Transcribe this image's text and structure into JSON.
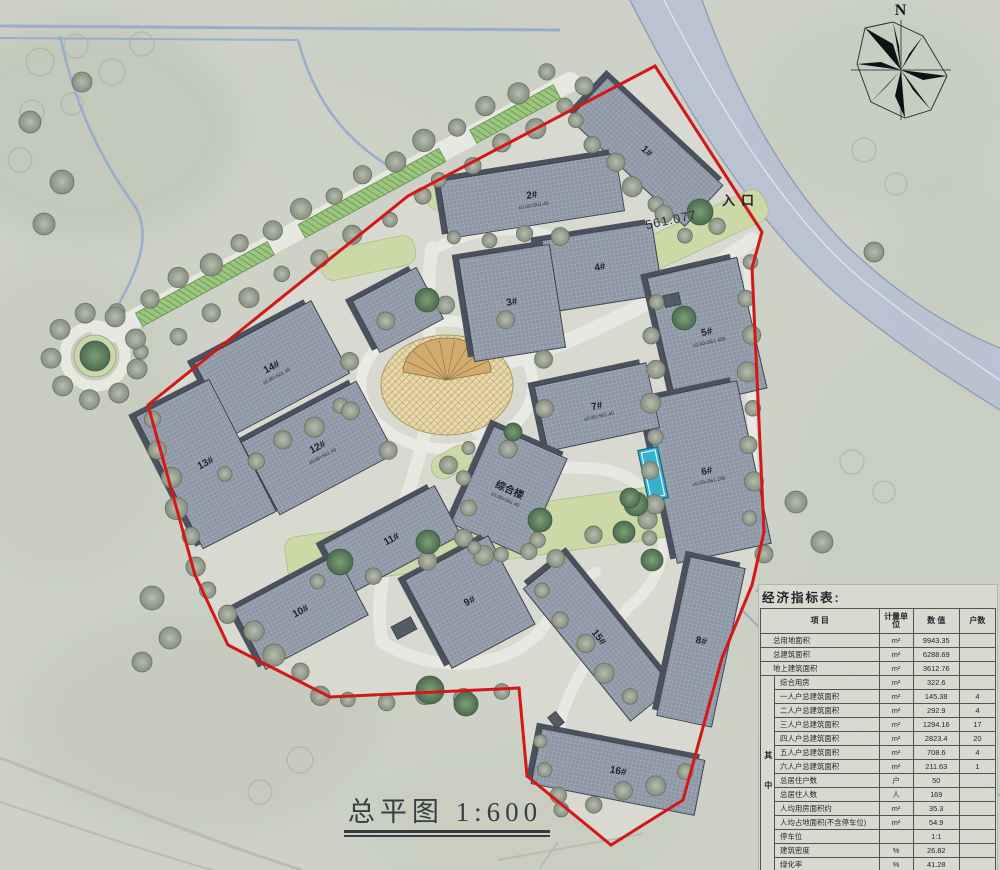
{
  "labels": {
    "north": "N",
    "entrance": "入口",
    "elevation": "561.077",
    "title": "总平图 1:600"
  },
  "table": {
    "title": "经济指标表:",
    "col_headers": [
      "项  目",
      "计量单位",
      "数  值",
      "户数"
    ],
    "among_label": "其中",
    "rows": [
      {
        "item": "总用地面积",
        "unit": "m²",
        "value": "9943.35",
        "count": "",
        "sub": false
      },
      {
        "item": "总建筑面积",
        "unit": "m²",
        "value": "6288.69",
        "count": "",
        "sub": false
      },
      {
        "item": "地上建筑面积",
        "unit": "m²",
        "value": "3612.76",
        "count": "",
        "sub": false
      },
      {
        "item": "综合用房",
        "unit": "m²",
        "value": "322.6",
        "count": "",
        "sub": true
      },
      {
        "item": "一人户总建筑面积",
        "unit": "m²",
        "value": "145.38",
        "count": "4",
        "sub": true
      },
      {
        "item": "二人户总建筑面积",
        "unit": "m²",
        "value": "292.9",
        "count": "4",
        "sub": true
      },
      {
        "item": "三人户总建筑面积",
        "unit": "m²",
        "value": "1294.16",
        "count": "17",
        "sub": true
      },
      {
        "item": "四人户总建筑面积",
        "unit": "m²",
        "value": "2823.4",
        "count": "20",
        "sub": true
      },
      {
        "item": "五人户总建筑面积",
        "unit": "m²",
        "value": "708.6",
        "count": "4",
        "sub": true
      },
      {
        "item": "六人户总建筑面积",
        "unit": "m²",
        "value": "211.63",
        "count": "1",
        "sub": true
      },
      {
        "item": "总居住户数",
        "unit": "户",
        "value": "50",
        "count": "",
        "sub": true
      },
      {
        "item": "总居住人数",
        "unit": "人",
        "value": "169",
        "count": "",
        "sub": true
      },
      {
        "item": "人均用房面积约",
        "unit": "m²",
        "value": "35.3",
        "count": "",
        "sub": true
      },
      {
        "item": "人均占地面积(不含停车位)",
        "unit": "m²",
        "value": "54.9",
        "count": "",
        "sub": true
      },
      {
        "item": "停车位",
        "unit": "",
        "value": "1:1",
        "count": "",
        "sub": true
      },
      {
        "item": "建筑密度",
        "unit": "%",
        "value": "26.82",
        "count": "",
        "sub": true
      },
      {
        "item": "绿化率",
        "unit": "%",
        "value": "41.28",
        "count": "",
        "sub": true
      },
      {
        "item": "容积率",
        "unit": "",
        "value": "0.65",
        "count": "",
        "sub": true
      }
    ]
  },
  "colors": {
    "ground": "#cdd1c7",
    "site": "#d8dad2",
    "road": "#e7e8e2",
    "road_band": "#b7c1d2",
    "boundary_red": "#d41717",
    "roof": "#8e97a6",
    "roof_shadow": "#4b525d",
    "tree_gray": "#9aa294",
    "tree_green": "#5d7f60",
    "lawn": "#ccd8a6",
    "hedge": "#9cc67e",
    "plaza": "#e8d9ab",
    "pool": "#38b0cc"
  },
  "map": {
    "boundary": "655,66 762,232 752,268 764,532 752,585 722,658 683,800 611,845 527,776 519,688 330,697 228,645 195,575 148,405 408,196",
    "band": {
      "fill": "M630,0 C690,120 762,232 848,304 C908,352 955,382 1000,410 L1000,348 C950,328 905,298 862,260 C800,206 742,112 702,0 Z",
      "edge1": "M630,0 C690,120 762,232 848,304 C908,352 955,382 1000,410",
      "edge2": "M702,0 C742,112 800,206 862,260 C905,298 950,328 1000,348",
      "center": "M664,0 C724,118 795,228 872,288 C925,330 962,354 1000,380"
    },
    "streams": [
      {
        "d": "M0,26 L560,30",
        "w": 3
      },
      {
        "d": "M0,38 L298,40",
        "w": 2
      },
      {
        "d": "M298,40 C312,92 338,136 392,168",
        "w": 2.5
      },
      {
        "d": "M60,36 C74,100 96,152 132,202 C150,226 144,258 122,298",
        "w": 2.5
      },
      {
        "d": "M122,298 C112,318 104,336 100,352",
        "w": 2
      }
    ],
    "faint_paths": [
      {
        "d": "M0,758 C90,792 200,838 302,870",
        "w": 3,
        "c": "#b9bdb0"
      },
      {
        "d": "M0,802 C70,826 150,852 212,870",
        "w": 2,
        "c": "#b9bdb0"
      },
      {
        "d": "M498,860 L642,834",
        "w": 2,
        "c": "#b9bdb0"
      },
      {
        "d": "M540,868 L558,842",
        "w": 2,
        "c": "#b9bdb0"
      },
      {
        "d": "M756,590 L1000,796",
        "w": 2,
        "c": "#9fabbd"
      },
      {
        "d": "M740,608 L978,850",
        "w": 2,
        "c": "#9fabbd"
      }
    ],
    "roads": [
      {
        "d": "M100,338 L570,82",
        "w": 20
      },
      {
        "d": "M752,240 C688,286 640,306 588,332 C544,352 506,362 476,372",
        "w": 15
      },
      {
        "d": "M432,248 C424,300 432,344 430,386 C428,436 414,476 398,522 C386,556 374,600 382,642",
        "w": 13
      },
      {
        "d": "M470,424 C506,458 544,468 584,468 C636,468 658,498 664,540",
        "w": 12
      },
      {
        "d": "M382,642 C440,678 520,668 548,620",
        "w": 12
      },
      {
        "d": "M430,252 C462,232 500,226 534,232 C570,240 602,252 622,262",
        "w": 11
      },
      {
        "d": "M664,540 C662,572 648,592 628,608",
        "w": 11
      },
      {
        "d": "M628,608 C600,640 572,680 562,716 C557,738 562,756 572,772",
        "w": 11
      },
      {
        "d": "M548,620 C560,600 576,584 596,572",
        "w": 10
      },
      {
        "d": "M748,258 C750,330 752,424 754,520",
        "w": 9
      }
    ],
    "roundabout": {
      "cx": 95,
      "cy": 356,
      "r_outer": 30,
      "r_inner": 21
    },
    "plaza": {
      "cx": 447,
      "cy": 385,
      "rx": 66,
      "ry": 50,
      "ring_rx": 86,
      "ring_ry": 64
    },
    "pool": {
      "cx": 653,
      "cy": 474,
      "w": 20,
      "h": 52,
      "rot": -12
    },
    "hedges": [
      {
        "cx": 205,
        "cy": 284,
        "w": 150,
        "h": 15,
        "rot": -28.5
      },
      {
        "cx": 372,
        "cy": 193,
        "w": 160,
        "h": 15,
        "rot": -28.5
      },
      {
        "cx": 515,
        "cy": 114,
        "w": 95,
        "h": 15,
        "rot": -28.5
      }
    ],
    "lawns": [
      {
        "cx": 480,
        "cy": 537,
        "w": 390,
        "h": 52,
        "rot": -8
      },
      {
        "cx": 688,
        "cy": 237,
        "w": 170,
        "h": 34,
        "rot": -25
      },
      {
        "cx": 368,
        "cy": 258,
        "w": 96,
        "h": 30,
        "rot": -12
      },
      {
        "cx": 468,
        "cy": 192,
        "w": 84,
        "h": 26,
        "rot": -10
      },
      {
        "cx": 452,
        "cy": 462,
        "w": 44,
        "h": 24,
        "rot": -30
      }
    ],
    "tree_rows": [
      [
        118,
        314,
        548,
        74,
        15,
        10
      ],
      [
        142,
        354,
        424,
        198,
        9,
        9
      ],
      [
        440,
        182,
        566,
        108,
        5,
        9
      ],
      [
        150,
        420,
        198,
        566,
        6,
        10
      ],
      [
        206,
        592,
        322,
        694,
        6,
        10
      ],
      [
        348,
        702,
        502,
        694,
        5,
        9
      ],
      [
        748,
        262,
        752,
        518,
        8,
        9
      ],
      [
        574,
        122,
        654,
        206,
        5,
        9
      ],
      [
        686,
        238,
        716,
        224,
        2,
        9
      ],
      [
        454,
        240,
        560,
        234,
        4,
        8
      ],
      [
        318,
        584,
        648,
        522,
        7,
        9
      ],
      [
        540,
        592,
        628,
        698,
        5,
        9
      ],
      [
        466,
        448,
        466,
        538,
        4,
        8
      ],
      [
        474,
        550,
        556,
        556,
        4,
        8
      ],
      [
        654,
        302,
        652,
        538,
        8,
        9
      ],
      [
        562,
        812,
        686,
        774,
        5,
        9
      ],
      [
        538,
        742,
        556,
        796,
        3,
        8
      ],
      [
        226,
        476,
        342,
        408,
        5,
        9
      ]
    ],
    "tree_rings": [
      {
        "cx": 95,
        "cy": 356,
        "rx": 44,
        "ry": 44,
        "n": 9,
        "tr": 10
      },
      {
        "cx": 447,
        "cy": 385,
        "rx": 102,
        "ry": 80,
        "n": 10,
        "tr": 9
      }
    ],
    "trees_gray": [
      [
        62,
        182,
        12
      ],
      [
        44,
        224,
        11
      ],
      [
        30,
        122,
        11
      ],
      [
        82,
        82,
        10
      ],
      [
        152,
        598,
        12
      ],
      [
        170,
        638,
        11
      ],
      [
        142,
        662,
        10
      ],
      [
        796,
        502,
        11
      ],
      [
        822,
        542,
        11
      ],
      [
        874,
        252,
        10
      ],
      [
        764,
        554,
        9
      ],
      [
        584,
        86,
        9
      ],
      [
        664,
        214,
        9
      ]
    ],
    "trees_dark": [
      [
        95,
        356,
        15
      ],
      [
        700,
        212,
        13
      ],
      [
        684,
        318,
        12
      ],
      [
        427,
        300,
        12
      ],
      [
        340,
        562,
        13
      ],
      [
        428,
        542,
        12
      ],
      [
        540,
        520,
        12
      ],
      [
        636,
        504,
        12
      ],
      [
        430,
        690,
        14
      ],
      [
        466,
        704,
        12
      ],
      [
        624,
        532,
        11
      ],
      [
        652,
        560,
        11
      ],
      [
        513,
        432,
        9
      ],
      [
        630,
        498,
        10
      ]
    ],
    "ghost_trees": [
      [
        40,
        62,
        14
      ],
      [
        76,
        46,
        12
      ],
      [
        112,
        72,
        13
      ],
      [
        32,
        112,
        12
      ],
      [
        72,
        104,
        11
      ],
      [
        142,
        44,
        12
      ],
      [
        20,
        160,
        12
      ],
      [
        864,
        150,
        12
      ],
      [
        896,
        184,
        11
      ],
      [
        852,
        462,
        12
      ],
      [
        884,
        492,
        11
      ],
      [
        300,
        760,
        13
      ],
      [
        260,
        792,
        12
      ]
    ],
    "mottles": [
      [
        90,
        130,
        150,
        110,
        "#bcc3b1",
        0.55
      ],
      [
        60,
        420,
        120,
        160,
        "#c3c9b8",
        0.5
      ],
      [
        200,
        720,
        180,
        110,
        "#bfc5b4",
        0.5
      ],
      [
        520,
        820,
        160,
        70,
        "#c6cbbc",
        0.5
      ],
      [
        880,
        110,
        130,
        100,
        "#c2c8b8",
        0.45
      ],
      [
        920,
        480,
        120,
        140,
        "#c4cabb",
        0.4
      ],
      [
        820,
        640,
        100,
        80,
        "#c8ccc0",
        0.4
      ],
      [
        420,
        60,
        120,
        60,
        "#c8cdbf",
        0.5
      ],
      [
        960,
        260,
        80,
        90,
        "#bfc7b9",
        0.4
      ],
      [
        340,
        120,
        90,
        50,
        "#cdd1c4",
        0.5
      ]
    ],
    "sheds": [
      [
        404,
        628,
        22,
        14,
        -28
      ],
      [
        672,
        300,
        16,
        12,
        -12
      ],
      [
        556,
        720,
        14,
        10,
        51
      ]
    ],
    "buildings": [
      {
        "label": "1#",
        "sub": "",
        "cx": 646,
        "cy": 152,
        "w": 158,
        "h": 56,
        "rot": 43
      },
      {
        "label": "2#",
        "sub": "±0.00=561.40",
        "cx": 532,
        "cy": 196,
        "w": 178,
        "h": 58,
        "rot": -9
      },
      {
        "label": "4#",
        "sub": "",
        "cx": 600,
        "cy": 268,
        "w": 116,
        "h": 72,
        "rot": -9
      },
      {
        "label": "3#",
        "sub": "",
        "cx": 512,
        "cy": 303,
        "w": 92,
        "h": 104,
        "rot": -9
      },
      {
        "label": "5#",
        "sub": "±0.00=561.400",
        "cx": 707,
        "cy": 333,
        "w": 92,
        "h": 134,
        "rot": -13
      },
      {
        "label": "6#",
        "sub": "±0.00=561.200",
        "cx": 707,
        "cy": 472,
        "w": 96,
        "h": 166,
        "rot": -12
      },
      {
        "label": "7#",
        "sub": "±0.00=561.40",
        "cx": 597,
        "cy": 407,
        "w": 114,
        "h": 66,
        "rot": -12
      },
      {
        "label": "综合楼",
        "sub": "±0.00=561.40",
        "cx": 509,
        "cy": 491,
        "w": 80,
        "h": 106,
        "rot": 24
      },
      {
        "label": "14#",
        "sub": "±0.00=561.40",
        "cx": 272,
        "cy": 368,
        "w": 132,
        "h": 82,
        "rot": -28
      },
      {
        "label": "12#",
        "sub": "±0.00=561.40",
        "cx": 318,
        "cy": 448,
        "w": 130,
        "h": 82,
        "rot": -28
      },
      {
        "label": "13#",
        "sub": "",
        "cx": 206,
        "cy": 464,
        "w": 82,
        "h": 148,
        "rot": -27
      },
      {
        "label": "11#",
        "sub": "",
        "cx": 392,
        "cy": 540,
        "w": 126,
        "h": 56,
        "rot": -28
      },
      {
        "label": "10#",
        "sub": "",
        "cx": 301,
        "cy": 612,
        "w": 116,
        "h": 68,
        "rot": -28
      },
      {
        "label": "9#",
        "sub": "",
        "cx": 470,
        "cy": 602,
        "w": 94,
        "h": 100,
        "rot": -28
      },
      {
        "label": "15#",
        "sub": "",
        "cx": 598,
        "cy": 638,
        "w": 170,
        "h": 54,
        "rot": 51
      },
      {
        "label": "8#",
        "sub": "",
        "cx": 701,
        "cy": 642,
        "w": 56,
        "h": 162,
        "rot": 12
      },
      {
        "label": "16#",
        "sub": "",
        "cx": 618,
        "cy": 772,
        "w": 166,
        "h": 56,
        "rot": 11
      },
      {
        "label": "",
        "sub": "",
        "cx": 398,
        "cy": 310,
        "w": 72,
        "h": 58,
        "rot": -28
      }
    ]
  }
}
